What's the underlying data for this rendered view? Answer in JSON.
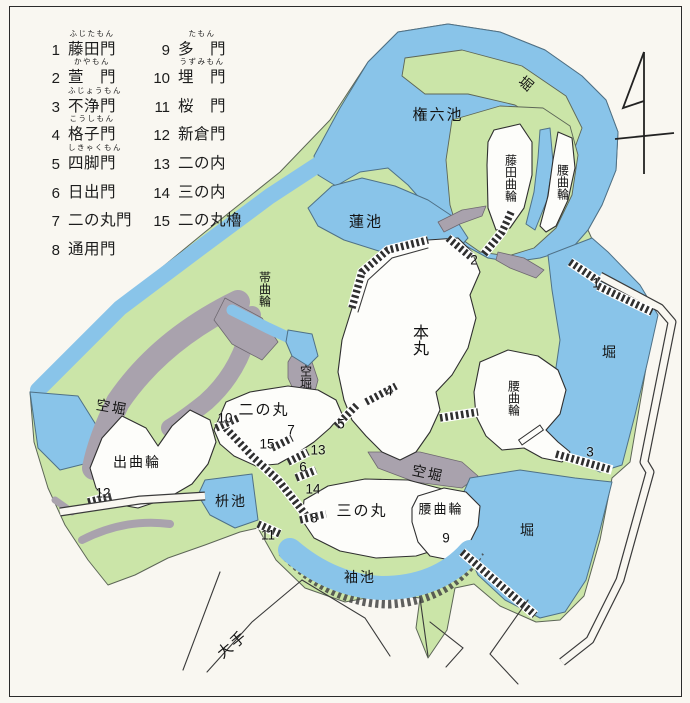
{
  "title": "castle map with numbered gates",
  "legend": {
    "columns": [
      {
        "items": [
          {
            "num": "1",
            "name": "藤田門",
            "furigana": "ふじたもん"
          },
          {
            "num": "2",
            "name": "萱　門",
            "furigana": "かやもん"
          },
          {
            "num": "3",
            "name": "不浄門",
            "furigana": "ふじょうもん"
          },
          {
            "num": "4",
            "name": "格子門",
            "furigana": "こうしもん"
          },
          {
            "num": "5",
            "name": "四脚門",
            "furigana": "しきゃくもん"
          },
          {
            "num": "6",
            "name": "日出門"
          },
          {
            "num": "7",
            "name": "二の丸門"
          },
          {
            "num": "8",
            "name": "通用門"
          }
        ]
      },
      {
        "items": [
          {
            "num": "9",
            "name": "多　門",
            "furigana": "たもん"
          },
          {
            "num": "10",
            "name": "埋　門",
            "furigana": "うずみもん"
          },
          {
            "num": "11",
            "name": "桜　門"
          },
          {
            "num": "12",
            "name": "新倉門"
          },
          {
            "num": "13",
            "name": "二の内"
          },
          {
            "num": "14",
            "name": "三の内"
          },
          {
            "num": "15",
            "name": "二の丸櫓"
          }
        ]
      }
    ]
  },
  "compass": {
    "symbol": "north-arrow"
  },
  "map": {
    "colors": {
      "water": "#89c4e9",
      "bank_green": "#cbe5a8",
      "dry_moat_gray": "#a9a2ad",
      "bailey_white": "#fdfdfa",
      "background": "#f9f7f1",
      "line": "#2f2f2f"
    },
    "labels": [
      {
        "text": "権六池",
        "x": 438,
        "y": 114,
        "orient": "h",
        "rot": 0,
        "size": 15
      },
      {
        "text": "堀",
        "x": 527,
        "y": 84,
        "orient": "h",
        "rot": 40,
        "size": 14
      },
      {
        "text": "藤田曲輪",
        "x": 511,
        "y": 178,
        "orient": "v",
        "rot": 0,
        "size": 12
      },
      {
        "text": "腰曲輪",
        "x": 563,
        "y": 182,
        "orient": "v",
        "rot": 0,
        "size": 12
      },
      {
        "text": "蓮池",
        "x": 366,
        "y": 221,
        "orient": "h",
        "rot": 0,
        "size": 15
      },
      {
        "text": "帯曲輪",
        "x": 265,
        "y": 289,
        "orient": "v",
        "rot": 0,
        "size": 12
      },
      {
        "text": "本丸",
        "x": 418,
        "y": 340,
        "orient": "v",
        "rot": 0,
        "size": 16
      },
      {
        "text": "空堀",
        "x": 306,
        "y": 377,
        "orient": "v",
        "rot": 0,
        "size": 12
      },
      {
        "text": "空堀",
        "x": 112,
        "y": 407,
        "orient": "h",
        "rot": 10,
        "size": 14
      },
      {
        "text": "出曲輪",
        "x": 137,
        "y": 462,
        "orient": "h",
        "rot": 0,
        "size": 14
      },
      {
        "text": "二の丸",
        "x": 264,
        "y": 409,
        "orient": "h",
        "rot": 0,
        "size": 15
      },
      {
        "text": "枡池",
        "x": 231,
        "y": 501,
        "orient": "h",
        "rot": 0,
        "size": 14
      },
      {
        "text": "三の丸",
        "x": 362,
        "y": 510,
        "orient": "h",
        "rot": 0,
        "size": 15
      },
      {
        "text": "空堀",
        "x": 428,
        "y": 473,
        "orient": "h",
        "rot": 12,
        "size": 14
      },
      {
        "text": "腰曲輪",
        "x": 441,
        "y": 508,
        "orient": "h",
        "rot": 0,
        "size": 13
      },
      {
        "text": "腰曲輪",
        "x": 514,
        "y": 398,
        "orient": "v",
        "rot": 0,
        "size": 12
      },
      {
        "text": "堀",
        "x": 610,
        "y": 352,
        "orient": "h",
        "rot": 0,
        "size": 14
      },
      {
        "text": "堀",
        "x": 528,
        "y": 530,
        "orient": "h",
        "rot": 0,
        "size": 14
      },
      {
        "text": "袖池",
        "x": 360,
        "y": 577,
        "orient": "h",
        "rot": 0,
        "size": 14
      },
      {
        "text": "大手",
        "x": 232,
        "y": 644,
        "orient": "h",
        "rot": -40,
        "size": 15
      }
    ],
    "gate_numbers": [
      {
        "n": "1",
        "x": 596,
        "y": 283
      },
      {
        "n": "2",
        "x": 474,
        "y": 260
      },
      {
        "n": "3",
        "x": 590,
        "y": 452
      },
      {
        "n": "4",
        "x": 389,
        "y": 391
      },
      {
        "n": "5",
        "x": 341,
        "y": 424
      },
      {
        "n": "6",
        "x": 303,
        "y": 467
      },
      {
        "n": "7",
        "x": 291,
        "y": 430
      },
      {
        "n": "8",
        "x": 314,
        "y": 518
      },
      {
        "n": "9",
        "x": 446,
        "y": 538
      },
      {
        "n": "10",
        "x": 225,
        "y": 418
      },
      {
        "n": "11",
        "x": 268,
        "y": 535
      },
      {
        "n": "12",
        "x": 103,
        "y": 493
      },
      {
        "n": "13",
        "x": 318,
        "y": 450
      },
      {
        "n": "14",
        "x": 313,
        "y": 489
      },
      {
        "n": "15",
        "x": 267,
        "y": 444
      }
    ]
  }
}
